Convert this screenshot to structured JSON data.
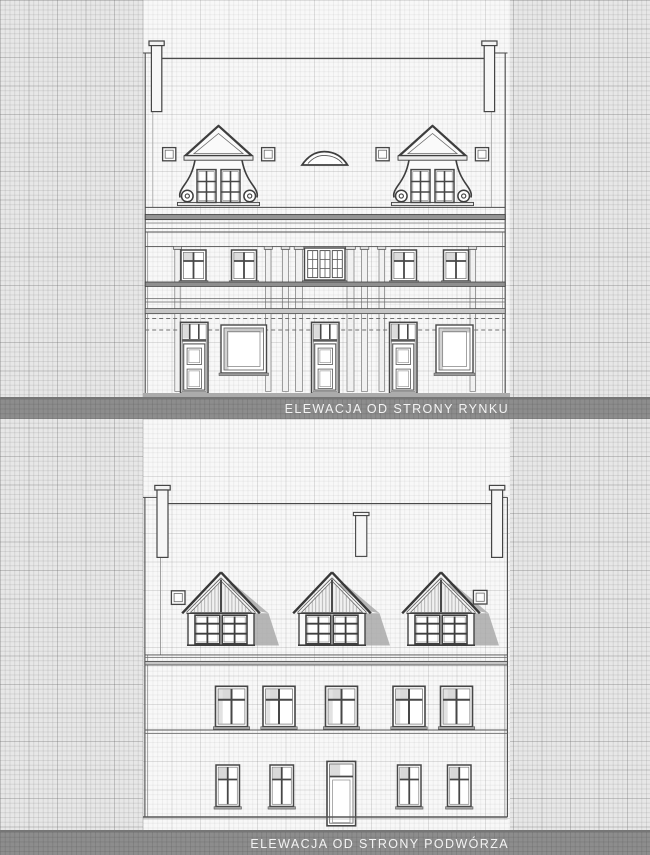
{
  "captions": {
    "top": "ELEWACJA OD STRONY RYNKU",
    "bottom": "ELEWACJA OD STRONY PODWÓRZA"
  },
  "colors": {
    "caption_band": "#8d8d8d",
    "caption_text": "#f3f3f3",
    "paper_sheet": "#f8f8f8",
    "grid_margin": "#e7e7e7",
    "ink": "#454545",
    "shadow": "#a0a0a0"
  }
}
